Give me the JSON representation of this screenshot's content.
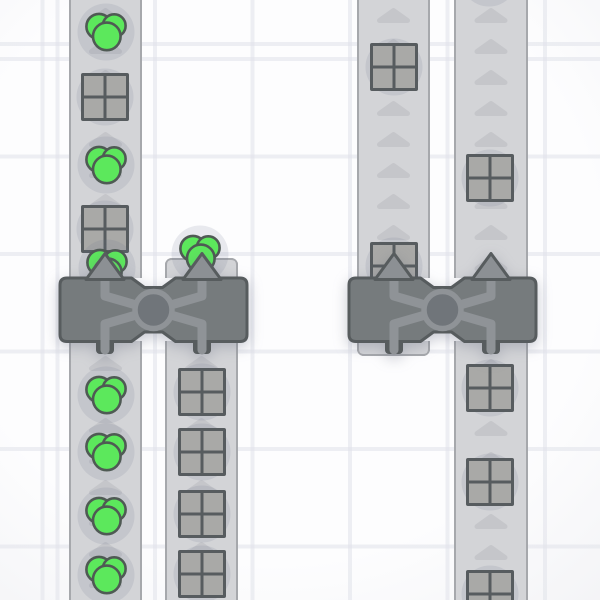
{
  "app": {
    "name": "factory-game-viewport",
    "visible_text": "none"
  },
  "viewport": {
    "width": 600,
    "height": 600
  },
  "colors": {
    "background": "#fdfdfe",
    "grid_line": "#e0e2e9",
    "belt": "#d3d4d7",
    "belt_edge": "#a6a8ac",
    "belt_arrow": "#c5c6ca",
    "item_shadow": "rgba(106,112,144,0.14)",
    "shape_gray_fill": "#a9a9a7",
    "shape_outline": "#575c5f",
    "circle_green_fill": "#5ce85c",
    "circle_green_outline": "#4f5a54",
    "balancer_body": "#767b7d",
    "balancer_outline": "#575c5e",
    "balancer_accent": "#8f9397",
    "balancer_inner_disc": "#70757a"
  },
  "scene": {
    "grid": {
      "spacing": 97.5,
      "line_width": 4,
      "offset_x": 55.5,
      "offset_y": 57
    },
    "belt_arrow": {
      "spacing": 31,
      "width": 33,
      "height": 15,
      "direction": "up"
    },
    "belts": [
      {
        "id": "belt-left-1-upper",
        "x": 69,
        "y": 0,
        "width": 73,
        "height": 278,
        "cap": "none",
        "arrow_phase": 8
      },
      {
        "id": "belt-left-2-upper-stub",
        "x": 165,
        "y": 258,
        "width": 73,
        "height": 20,
        "cap": "top",
        "arrow_phase": null
      },
      {
        "id": "belt-right-1-upper",
        "x": 357,
        "y": 0,
        "width": 73,
        "height": 278,
        "cap": "none",
        "arrow_phase": 8
      },
      {
        "id": "belt-right-2-upper",
        "x": 454,
        "y": 0,
        "width": 74,
        "height": 278,
        "cap": "none",
        "arrow_phase": 8
      },
      {
        "id": "belt-left-1-lower",
        "x": 69,
        "y": 341,
        "width": 73,
        "height": 259,
        "cap": "none",
        "arrow_phase": 15
      },
      {
        "id": "belt-left-2-lower",
        "x": 165,
        "y": 341,
        "width": 73,
        "height": 259,
        "cap": "none",
        "arrow_phase": 15
      },
      {
        "id": "belt-right-1-lower-stub",
        "x": 357,
        "y": 341,
        "width": 73,
        "height": 15,
        "cap": "bottom",
        "arrow_phase": null
      },
      {
        "id": "belt-right-2-lower",
        "x": 454,
        "y": 341,
        "width": 74,
        "height": 259,
        "cap": "none",
        "arrow_phase": 18
      }
    ],
    "balancers": [
      {
        "id": "balancer-left",
        "x": 59.5,
        "y": 277.5,
        "width": 187,
        "height": 63.5,
        "outputs": "up",
        "inputs": "down"
      },
      {
        "id": "balancer-right",
        "x": 348.5,
        "y": 277.5,
        "width": 187,
        "height": 63.5,
        "outputs": "up",
        "inputs": "down"
      }
    ],
    "items": [
      {
        "type": "circle-cluster",
        "x": 106,
        "y": 32
      },
      {
        "type": "windowed-square",
        "x": 105,
        "y": 97
      },
      {
        "type": "circle-cluster",
        "x": 106,
        "y": 165
      },
      {
        "type": "windowed-square",
        "x": 105,
        "y": 229
      },
      {
        "type": "circle-cluster",
        "x": 107,
        "y": 268
      },
      {
        "type": "circle-cluster",
        "x": 200,
        "y": 254
      },
      {
        "type": "circle-cluster",
        "x": 106,
        "y": 395
      },
      {
        "type": "circle-cluster",
        "x": 106,
        "y": 452
      },
      {
        "type": "circle-cluster",
        "x": 106,
        "y": 516
      },
      {
        "type": "circle-cluster",
        "x": 106,
        "y": 575
      },
      {
        "type": "windowed-square",
        "x": 202,
        "y": 392
      },
      {
        "type": "windowed-square",
        "x": 202,
        "y": 452
      },
      {
        "type": "windowed-square",
        "x": 202,
        "y": 514
      },
      {
        "type": "windowed-square",
        "x": 202,
        "y": 574
      },
      {
        "type": "windowed-square",
        "x": 394,
        "y": 67
      },
      {
        "type": "windowed-square",
        "x": 394,
        "y": 266
      },
      {
        "type": "windowed-square",
        "x": 490,
        "y": 178
      },
      {
        "type": "shadow-only",
        "x": 489,
        "y": -22
      },
      {
        "type": "windowed-square",
        "x": 490,
        "y": 388
      },
      {
        "type": "windowed-square",
        "x": 490,
        "y": 482
      },
      {
        "type": "windowed-square",
        "x": 490,
        "y": 594
      }
    ]
  }
}
